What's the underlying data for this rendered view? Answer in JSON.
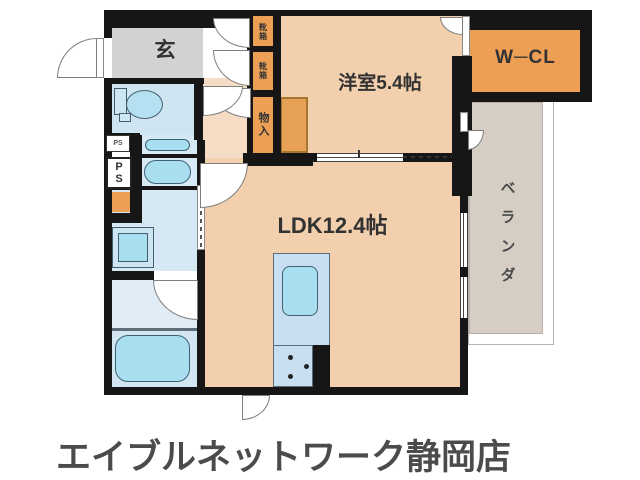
{
  "plan": {
    "rooms": {
      "genkan": "玄",
      "western_room": "洋室5.4帖",
      "walk_in_closet": "W─CL",
      "ldk": "LDK12.4帖",
      "veranda": "ベランダ",
      "storage": "物入",
      "shoe_box_upper": "靴箱",
      "shoe_box_lower": "靴箱",
      "pipe_space_small": "PS",
      "pipe_space_large": "PS"
    }
  },
  "footer": {
    "store_name": "エイブルネットワーク静岡店"
  },
  "colors": {
    "wall": "#161616",
    "room_peach": "#f2cfad",
    "corridor_peach": "#f5dcc5",
    "genkan_gray": "#d2d2d2",
    "closet_orange": "#ec9f55",
    "water_blue": "#d6e8f4",
    "fixture_cyan": "#a8def0",
    "veranda_gray": "#d6cec5",
    "footer_text": "#4b4b4b"
  }
}
